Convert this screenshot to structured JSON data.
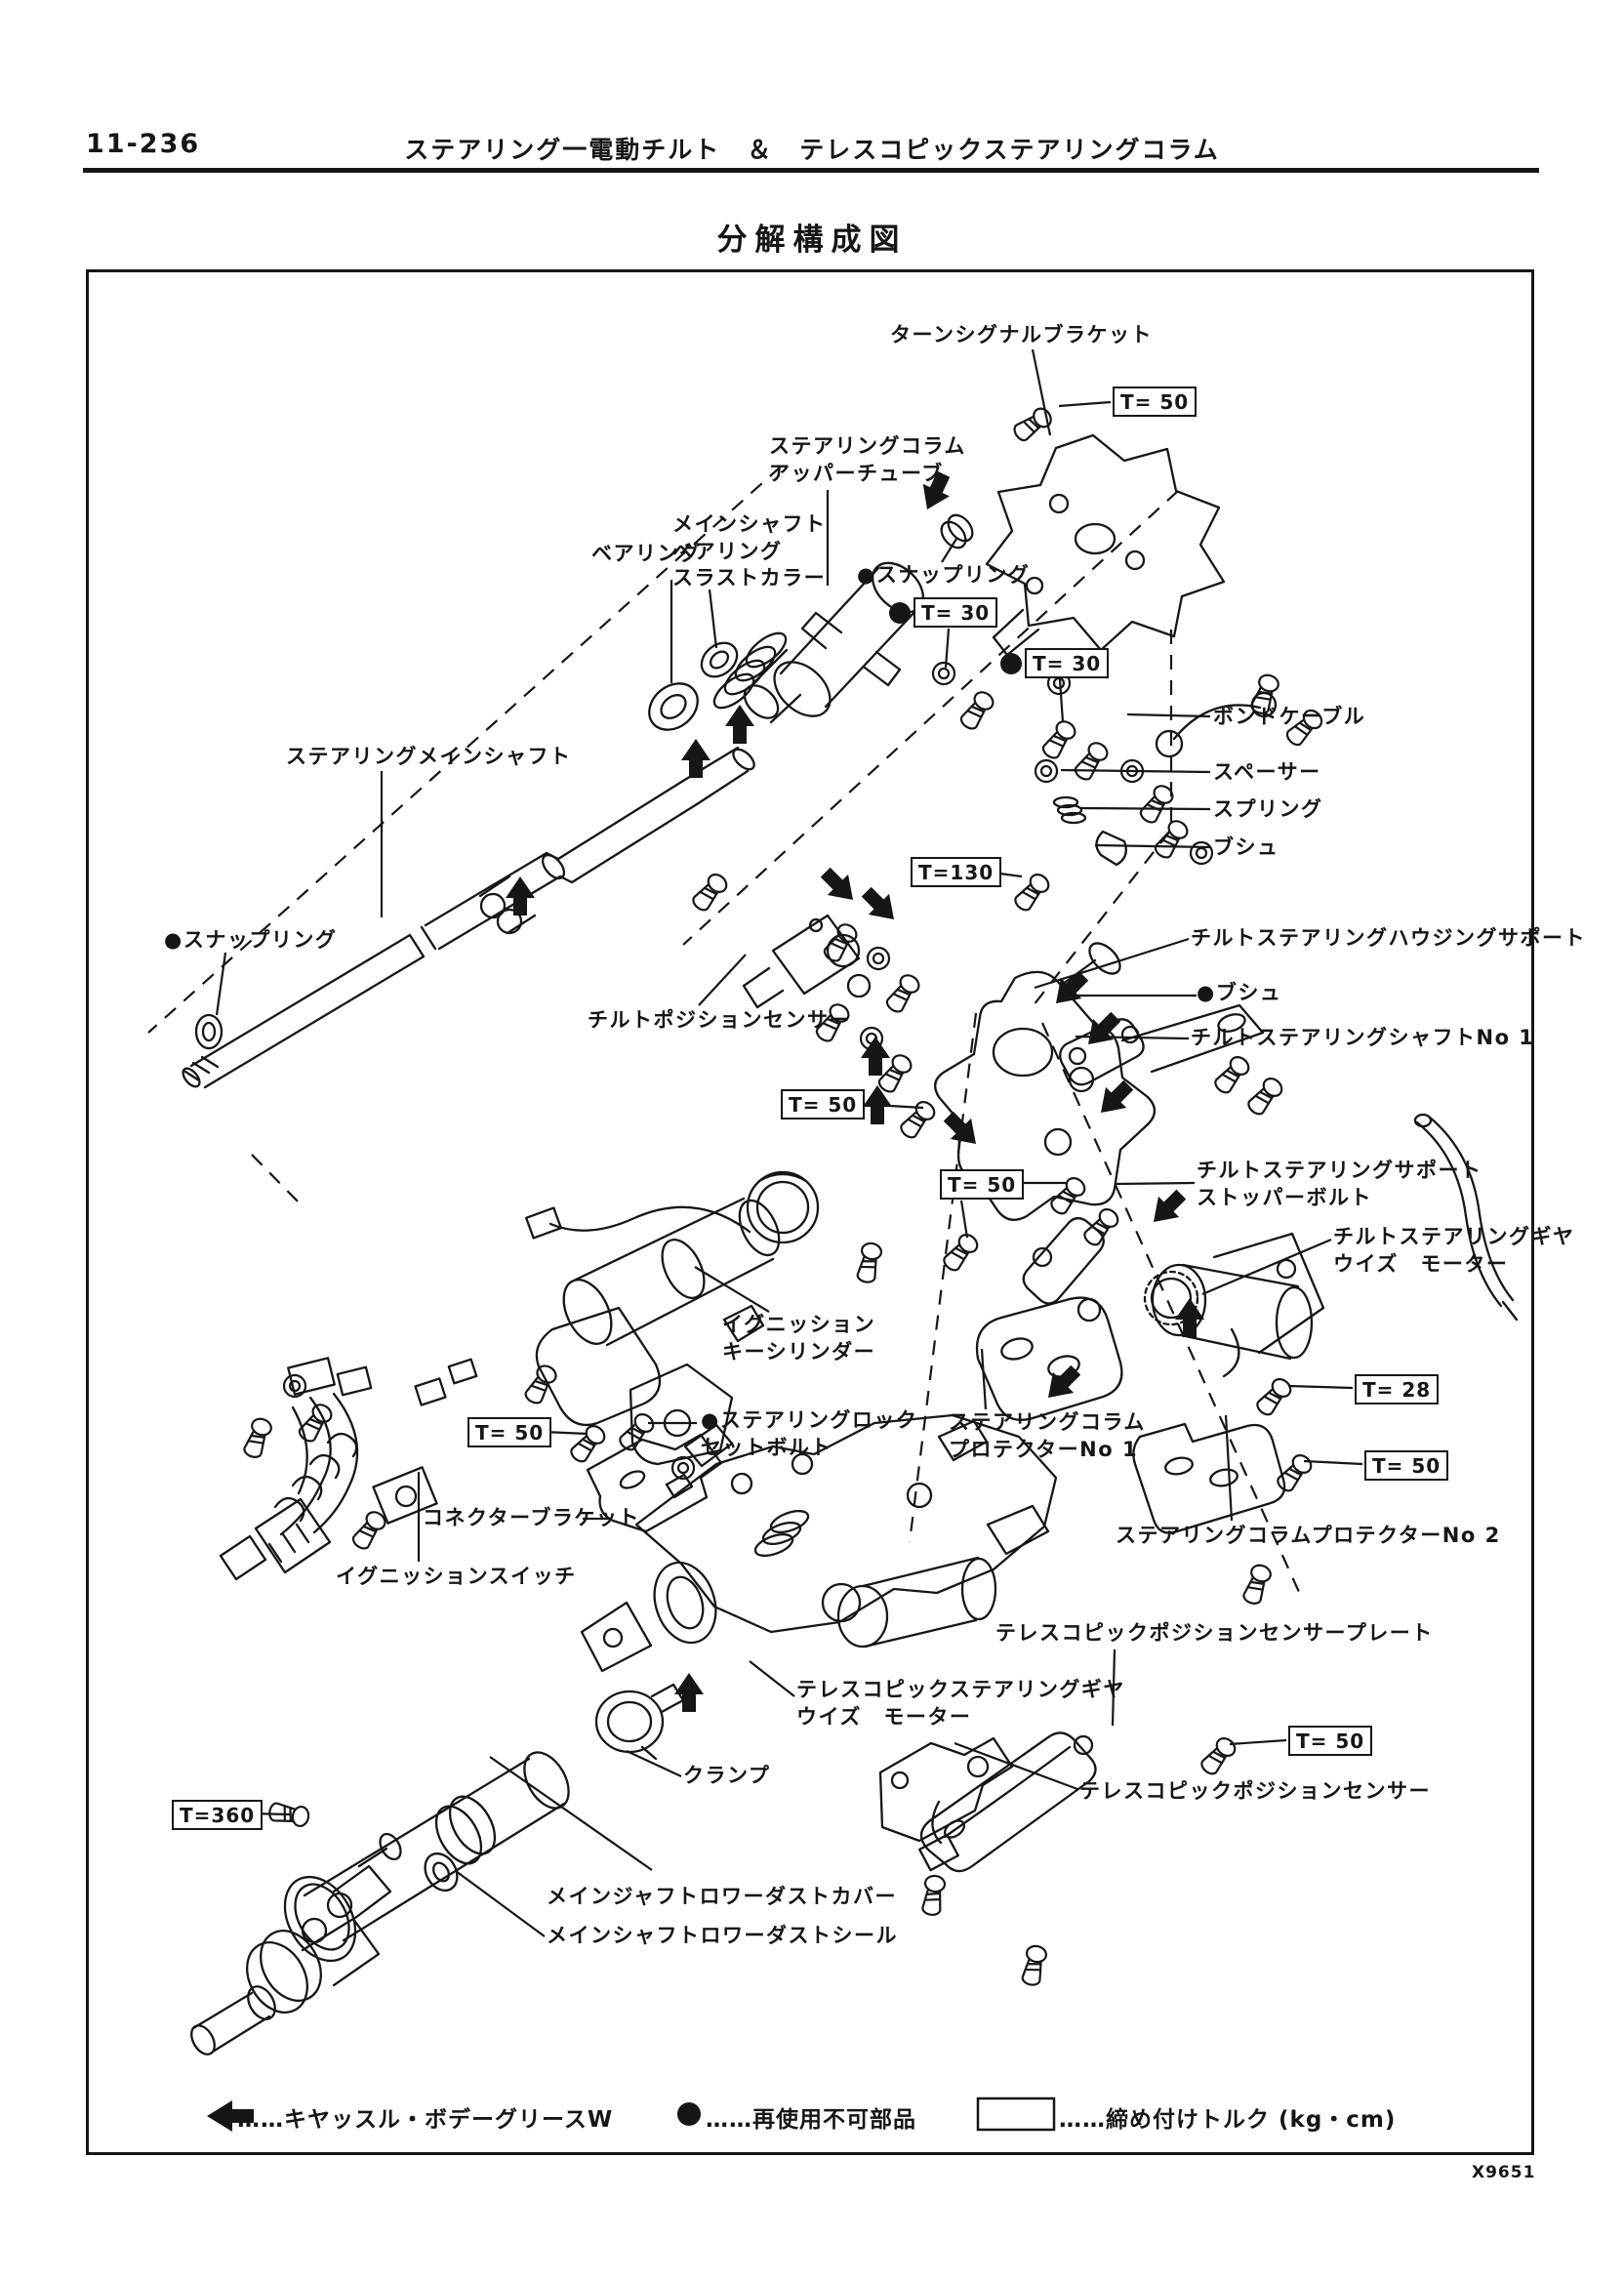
{
  "page": {
    "number": "11-236",
    "title": "ステアリング一電動チルト　＆　テレスコピックステアリングコラム",
    "section_title": "分解構成図",
    "figure_code": "X9651"
  },
  "legend": {
    "grease": "……キヤッスル・ボデーグリースW",
    "non_reusable": "……再使用不可部品",
    "torque_unit": "……締め付けトルク (kg・cm)"
  },
  "parts": [
    {
      "text": "ターンシグナルブラケット"
    },
    {
      "text": "ステアリングコラム\nアッパーチューブ"
    },
    {
      "text": "メインシャフト\nベアリング\nスラストカラー"
    },
    {
      "text": "ベアリング"
    },
    {
      "text": "●スナップリング"
    },
    {
      "text": "ボンドケーブル"
    },
    {
      "text": "スペーサー"
    },
    {
      "text": "スプリング"
    },
    {
      "text": "ブシュ"
    },
    {
      "text": "チルトステアリングハウジングサポート"
    },
    {
      "text": "ステアリングメインシャフト"
    },
    {
      "text": "●スナップリング"
    },
    {
      "text": "チルトポジションセンサー"
    },
    {
      "text": "●ブシュ"
    },
    {
      "text": "チルトステアリングシャフトNo 1"
    },
    {
      "text": "チルトステアリングサポート\nストッパーボルト"
    },
    {
      "text": "チルトステアリングギヤ\nウイズ　モーター"
    },
    {
      "text": "ステアリングコラム\nプロテクターNo 1"
    },
    {
      "text": "ステアリングコラムプロテクターNo 2"
    },
    {
      "text": "テレスコピックポジションセンサープレート"
    },
    {
      "text": "テレスコピックステアリングギヤ\nウイズ　モーター"
    },
    {
      "text": "テレスコピックポジションセンサー"
    },
    {
      "text": "クランプ"
    },
    {
      "text": "メインジャフトロワーダストカバー"
    },
    {
      "text": "メインシャフトロワーダストシール"
    },
    {
      "text": "イグニッション\nキーシリンダー"
    },
    {
      "text": "●ステアリングロック\nセットボルト"
    },
    {
      "text": "コネクターブラケット"
    },
    {
      "text": "イグニッションスイッチ"
    }
  ],
  "torques": [
    {
      "display": "T=  50",
      "non_reusable": false
    },
    {
      "display": "T=  30",
      "non_reusable": true
    },
    {
      "display": "T=  30",
      "non_reusable": true
    },
    {
      "display": "T=130",
      "non_reusable": false
    },
    {
      "display": "T=  50",
      "non_reusable": false
    },
    {
      "display": "T=  50",
      "non_reusable": false
    },
    {
      "display": "T=  50",
      "non_reusable": false
    },
    {
      "display": "T=  28",
      "non_reusable": false
    },
    {
      "display": "T=  50",
      "non_reusable": false
    },
    {
      "display": "T=  50",
      "non_reusable": false
    },
    {
      "display": "T=360",
      "non_reusable": false
    }
  ]
}
